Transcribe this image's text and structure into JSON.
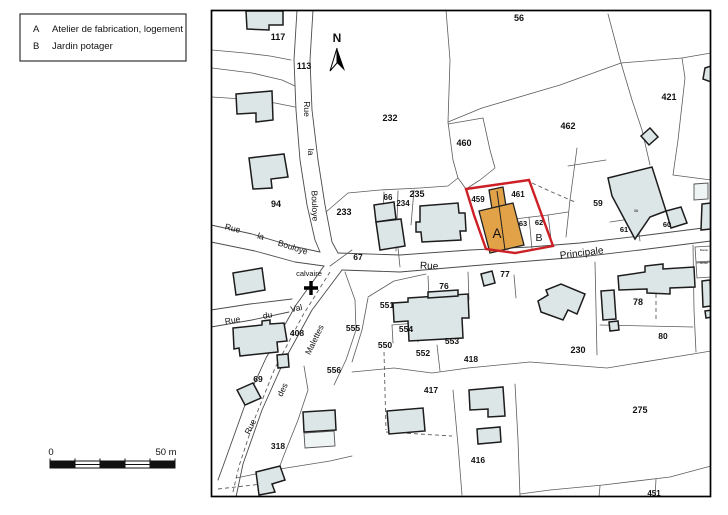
{
  "legend": {
    "items": [
      {
        "key": "A",
        "label": "Atelier de fabrication, logement"
      },
      {
        "key": "B",
        "label": "Jardin potager"
      }
    ]
  },
  "north": {
    "label": "N"
  },
  "scale_bar": {
    "start_label": "0",
    "end_label": "50 m"
  },
  "colors": {
    "building_fill": "#dde6e6",
    "building_fill_light": "#eef3f3",
    "building_stroke": "#1c1c1c",
    "lot_line": "#5c5c5c",
    "street_line": "#4a4a4a",
    "frame": "#000000",
    "highlight_red": "#cd2026",
    "orange_fill": "#e2a348",
    "orange_stroke": "#222222",
    "text": "#111111"
  },
  "map": {
    "labels": [
      {
        "t": "117",
        "x": 278,
        "y": 40,
        "b": true,
        "n": "parcel-117"
      },
      {
        "t": "113",
        "x": 304,
        "y": 69,
        "b": true,
        "n": "parcel-113"
      },
      {
        "t": "94",
        "x": 276,
        "y": 207,
        "b": true,
        "n": "parcel-94"
      },
      {
        "t": "232",
        "x": 390,
        "y": 121,
        "b": true,
        "n": "parcel-232"
      },
      {
        "t": "56",
        "x": 519,
        "y": 21,
        "b": true,
        "n": "parcel-56"
      },
      {
        "t": "460",
        "x": 464,
        "y": 146,
        "b": true,
        "n": "parcel-460"
      },
      {
        "t": "462",
        "x": 568,
        "y": 129,
        "b": true,
        "n": "parcel-462"
      },
      {
        "t": "421",
        "x": 669,
        "y": 100,
        "b": true,
        "n": "parcel-421"
      },
      {
        "t": "233",
        "x": 344,
        "y": 215,
        "b": true,
        "n": "parcel-233"
      },
      {
        "t": "66",
        "x": 388,
        "y": 200,
        "s": 8,
        "b": true,
        "n": "parcel-66"
      },
      {
        "t": "234",
        "x": 403,
        "y": 206,
        "s": 8,
        "b": true,
        "n": "parcel-234"
      },
      {
        "t": "235",
        "x": 417,
        "y": 197,
        "b": true,
        "n": "parcel-235"
      },
      {
        "t": "67",
        "x": 358,
        "y": 260,
        "s": 8.5,
        "b": true,
        "n": "parcel-67"
      },
      {
        "t": "459",
        "x": 478,
        "y": 202,
        "s": 8,
        "b": true,
        "n": "parcel-459"
      },
      {
        "t": "461",
        "x": 518,
        "y": 197,
        "s": 8,
        "b": true,
        "n": "parcel-461"
      },
      {
        "t": "63",
        "x": 523,
        "y": 226,
        "s": 7.5,
        "b": true,
        "n": "parcel-63"
      },
      {
        "t": "62",
        "x": 539,
        "y": 225,
        "s": 7.5,
        "b": true,
        "n": "parcel-62"
      },
      {
        "t": "59",
        "x": 598,
        "y": 206,
        "s": 8.5,
        "b": true,
        "n": "parcel-59"
      },
      {
        "t": "61",
        "x": 624,
        "y": 232,
        "s": 7.5,
        "b": true,
        "n": "parcel-61"
      },
      {
        "t": "60",
        "x": 667,
        "y": 227,
        "s": 7.5,
        "b": true,
        "n": "parcel-60"
      },
      {
        "t": "36",
        "x": 636,
        "y": 212,
        "s": 4,
        "n": "building-number-36"
      },
      {
        "t": "76",
        "x": 444,
        "y": 289,
        "s": 8.5,
        "b": true,
        "n": "parcel-76"
      },
      {
        "t": "77",
        "x": 505,
        "y": 277,
        "s": 8.5,
        "b": true,
        "n": "parcel-77"
      },
      {
        "t": "78",
        "x": 638,
        "y": 305,
        "b": true,
        "n": "parcel-78"
      },
      {
        "t": "80",
        "x": 663,
        "y": 339,
        "s": 8.5,
        "b": true,
        "n": "parcel-80"
      },
      {
        "t": "230",
        "x": 578,
        "y": 353,
        "b": true,
        "n": "parcel-230"
      },
      {
        "t": "275",
        "x": 640,
        "y": 413,
        "b": true,
        "n": "parcel-275"
      },
      {
        "t": "551",
        "x": 387,
        "y": 308,
        "s": 8.5,
        "b": true,
        "n": "parcel-551"
      },
      {
        "t": "554",
        "x": 406,
        "y": 332,
        "s": 8.5,
        "b": true,
        "n": "parcel-554"
      },
      {
        "t": "550",
        "x": 385,
        "y": 348,
        "s": 8.5,
        "b": true,
        "n": "parcel-550"
      },
      {
        "t": "552",
        "x": 423,
        "y": 356,
        "s": 8.5,
        "b": true,
        "n": "parcel-552"
      },
      {
        "t": "553",
        "x": 452,
        "y": 344,
        "s": 8.5,
        "b": true,
        "n": "parcel-553"
      },
      {
        "t": "555",
        "x": 353,
        "y": 331,
        "s": 8.5,
        "b": true,
        "n": "parcel-555"
      },
      {
        "t": "556",
        "x": 334,
        "y": 373,
        "s": 8.5,
        "b": true,
        "n": "parcel-556"
      },
      {
        "t": "418",
        "x": 471,
        "y": 362,
        "s": 8.5,
        "b": true,
        "n": "parcel-418"
      },
      {
        "t": "417",
        "x": 431,
        "y": 393,
        "s": 8.5,
        "b": true,
        "n": "parcel-417"
      },
      {
        "t": "416",
        "x": 478,
        "y": 463,
        "s": 8.5,
        "b": true,
        "n": "parcel-416"
      },
      {
        "t": "408",
        "x": 297,
        "y": 336,
        "s": 8.5,
        "b": true,
        "n": "parcel-408"
      },
      {
        "t": "69",
        "x": 258,
        "y": 382,
        "s": 8.5,
        "b": true,
        "n": "parcel-69"
      },
      {
        "t": "318",
        "x": 278,
        "y": 449,
        "s": 8.5,
        "b": true,
        "n": "parcel-318"
      },
      {
        "t": "451",
        "x": 654,
        "y": 496,
        "s": 8,
        "b": true,
        "n": "parcel-451"
      },
      {
        "t": "A",
        "x": 497,
        "y": 238,
        "s": 13.5,
        "n": "feature-label-A"
      },
      {
        "t": "B",
        "x": 539,
        "y": 241,
        "s": 10.5,
        "n": "feature-label-B"
      },
      {
        "t": "calvaire",
        "x": 309,
        "y": 276,
        "s": 7.5,
        "n": "calvaire-label"
      },
      {
        "t": "Mairie",
        "x": 704,
        "y": 251,
        "s": 3,
        "n": "mairie-label"
      },
      {
        "t": "Ecole",
        "x": 704,
        "y": 264,
        "s": 3,
        "n": "ecole-label"
      },
      {
        "t": "Rue",
        "x": 304,
        "y": 109,
        "s": 8.5,
        "r": 90,
        "n": "street-rue-la-bouloye-v-1"
      },
      {
        "t": "la",
        "x": 308,
        "y": 152,
        "s": 8.5,
        "r": 90,
        "n": "street-rue-la-bouloye-v-2"
      },
      {
        "t": "Bouloye",
        "x": 312,
        "y": 206,
        "s": 8.5,
        "r": 88,
        "n": "street-rue-la-bouloye-v-3"
      },
      {
        "t": "Rue",
        "x": 232,
        "y": 231,
        "s": 8.5,
        "r": 14,
        "n": "street-rue-la-bouloye-d-1"
      },
      {
        "t": "la",
        "x": 260,
        "y": 239,
        "s": 8.5,
        "r": 16,
        "n": "street-rue-la-bouloye-d-2"
      },
      {
        "t": "Bouloye",
        "x": 292,
        "y": 250,
        "s": 8.5,
        "r": 18,
        "n": "street-rue-la-bouloye-d-3"
      },
      {
        "t": "Rue",
        "x": 429,
        "y": 269,
        "s": 10,
        "r": 2,
        "n": "street-rue-principale-1"
      },
      {
        "t": "Principale",
        "x": 582,
        "y": 256,
        "s": 10,
        "r": -7,
        "n": "street-rue-principale-2"
      },
      {
        "t": "Rue",
        "x": 233,
        "y": 323,
        "s": 8.5,
        "r": -10,
        "n": "street-rue-du-val-1"
      },
      {
        "t": "du",
        "x": 268,
        "y": 318,
        "s": 8.5,
        "r": -10,
        "n": "street-rue-du-val-2"
      },
      {
        "t": "Val",
        "x": 297,
        "y": 311,
        "s": 8.5,
        "r": -12,
        "n": "street-rue-du-val-3"
      },
      {
        "t": "Malettes",
        "x": 317,
        "y": 341,
        "s": 8.5,
        "r": -64,
        "n": "street-rue-des-malettes-3"
      },
      {
        "t": "des",
        "x": 285,
        "y": 391,
        "s": 8.5,
        "r": -64,
        "n": "street-rue-des-malettes-2"
      },
      {
        "t": "Rue",
        "x": 253,
        "y": 428,
        "s": 8.5,
        "r": -64,
        "n": "street-rue-des-malettes-1"
      }
    ]
  }
}
